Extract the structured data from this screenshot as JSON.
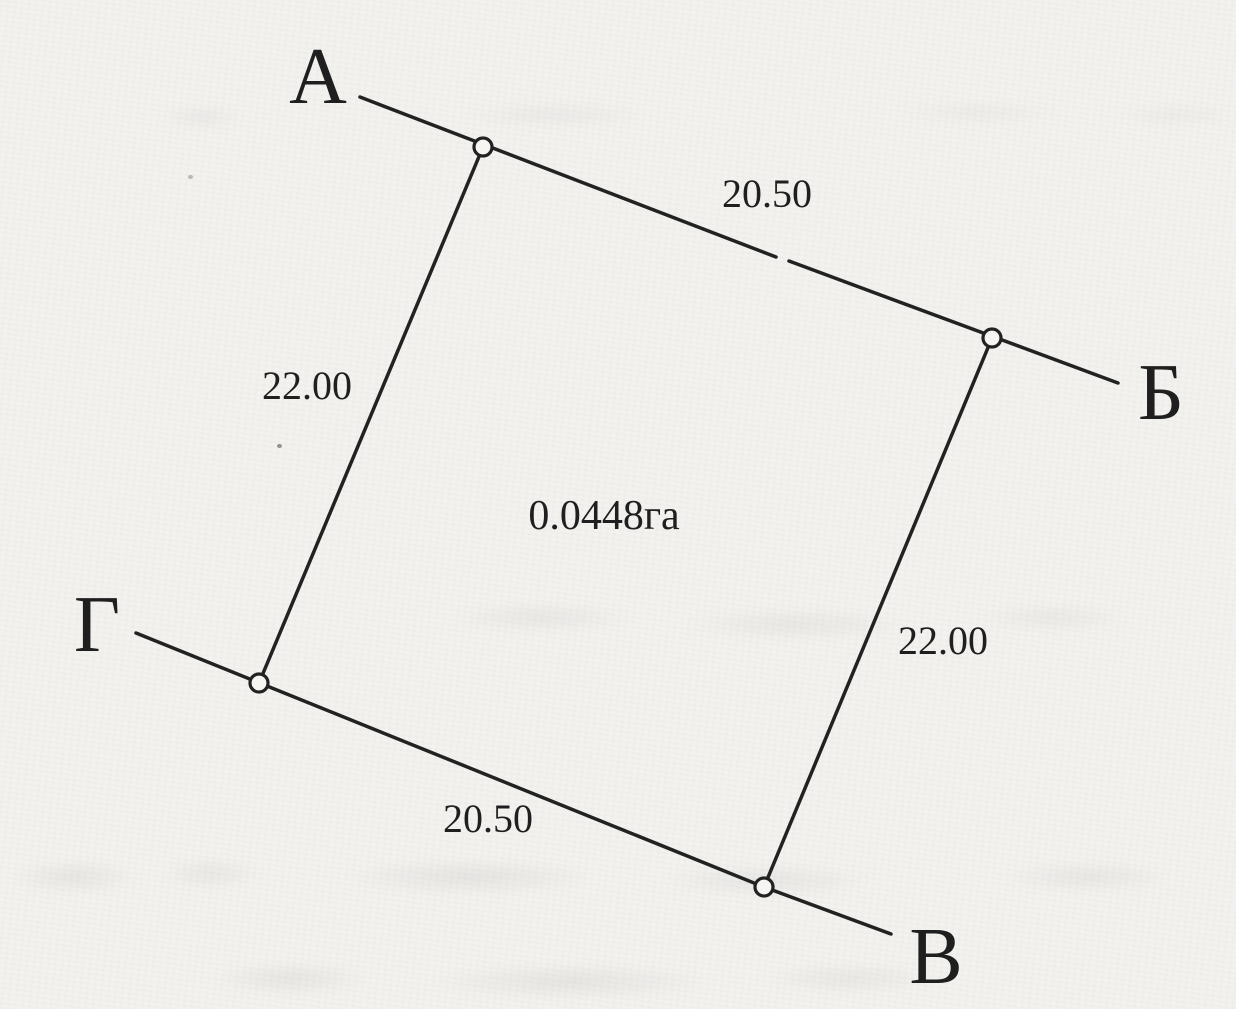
{
  "diagram": {
    "kind": "land-parcel-survey-sketch",
    "area_label": "0.0448га",
    "vertices": [
      {
        "id": "A",
        "label": "А"
      },
      {
        "id": "B",
        "label": "Б"
      },
      {
        "id": "V",
        "label": "В"
      },
      {
        "id": "G",
        "label": "Г"
      }
    ],
    "sides": [
      {
        "from": "А",
        "to": "Б",
        "length": "20.50"
      },
      {
        "from": "Б",
        "to": "В",
        "length": "22.00"
      },
      {
        "from": "Г",
        "to": "В",
        "length": "20.50"
      },
      {
        "from": "А",
        "to": "Г",
        "length": "22.00"
      }
    ],
    "colors": {
      "ink": "#222222",
      "paper": "#f3f2ef"
    }
  }
}
